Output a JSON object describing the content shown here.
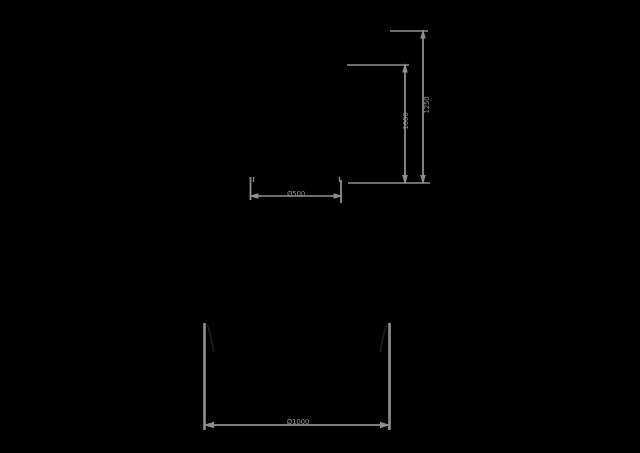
{
  "drawing": {
    "type": "technical-dimension-drawing",
    "background_color": "#000000",
    "line_color": "#8f8f8f",
    "silhouette_color": "#1d1d1d",
    "dimensions": {
      "total_height": {
        "label": "1250",
        "orientation": "vertical"
      },
      "partial_height": {
        "label": "1000",
        "orientation": "vertical"
      },
      "top_width": {
        "label": "Ø500",
        "orientation": "horizontal"
      },
      "bottom_width": {
        "label": "Ø1000",
        "orientation": "horizontal"
      }
    }
  }
}
